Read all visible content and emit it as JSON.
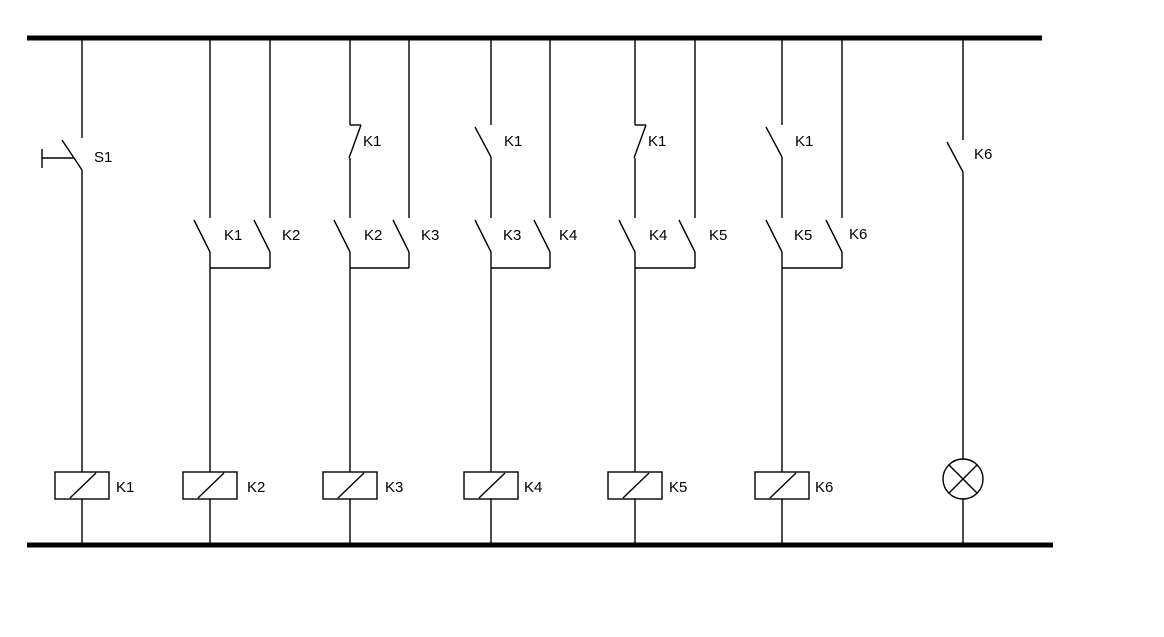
{
  "colors": {
    "line": "#000000",
    "background": "#ffffff"
  },
  "circuit": {
    "type": "relay-ladder-schematic",
    "rails": [
      "top-supply-rail",
      "bottom-return-rail"
    ],
    "rungs": [
      {
        "id": "rung-1",
        "series_contact": {
          "symbol": "pushbutton-no",
          "label": "S1"
        },
        "output": {
          "symbol": "relay-coil",
          "label": "K1"
        }
      },
      {
        "id": "rung-2",
        "parallel_contacts": [
          {
            "symbol": "contact-no",
            "label": "K1"
          },
          {
            "symbol": "contact-no",
            "label": "K2"
          }
        ],
        "output": {
          "symbol": "relay-coil",
          "label": "K2"
        }
      },
      {
        "id": "rung-3",
        "series_contact": {
          "symbol": "contact-nc",
          "label": "K1"
        },
        "parallel_contacts": [
          {
            "symbol": "contact-no",
            "label": "K2"
          },
          {
            "symbol": "contact-no",
            "label": "K3"
          }
        ],
        "output": {
          "symbol": "relay-coil",
          "label": "K3"
        }
      },
      {
        "id": "rung-4",
        "series_contact": {
          "symbol": "contact-no",
          "label": "K1"
        },
        "parallel_contacts": [
          {
            "symbol": "contact-no",
            "label": "K3"
          },
          {
            "symbol": "contact-no",
            "label": "K4"
          }
        ],
        "output": {
          "symbol": "relay-coil",
          "label": "K4"
        }
      },
      {
        "id": "rung-5",
        "series_contact": {
          "symbol": "contact-nc",
          "label": "K1"
        },
        "parallel_contacts": [
          {
            "symbol": "contact-no",
            "label": "K4"
          },
          {
            "symbol": "contact-no",
            "label": "K5"
          }
        ],
        "output": {
          "symbol": "relay-coil",
          "label": "K5"
        }
      },
      {
        "id": "rung-6",
        "series_contact": {
          "symbol": "contact-no",
          "label": "K1"
        },
        "parallel_contacts": [
          {
            "symbol": "contact-no",
            "label": "K5"
          },
          {
            "symbol": "contact-no",
            "label": "K6"
          }
        ],
        "output": {
          "symbol": "relay-coil",
          "label": "K6"
        }
      },
      {
        "id": "rung-7",
        "series_contact": {
          "symbol": "contact-no",
          "label": "K6"
        },
        "output": {
          "symbol": "indicator-lamp",
          "label": ""
        }
      }
    ]
  }
}
